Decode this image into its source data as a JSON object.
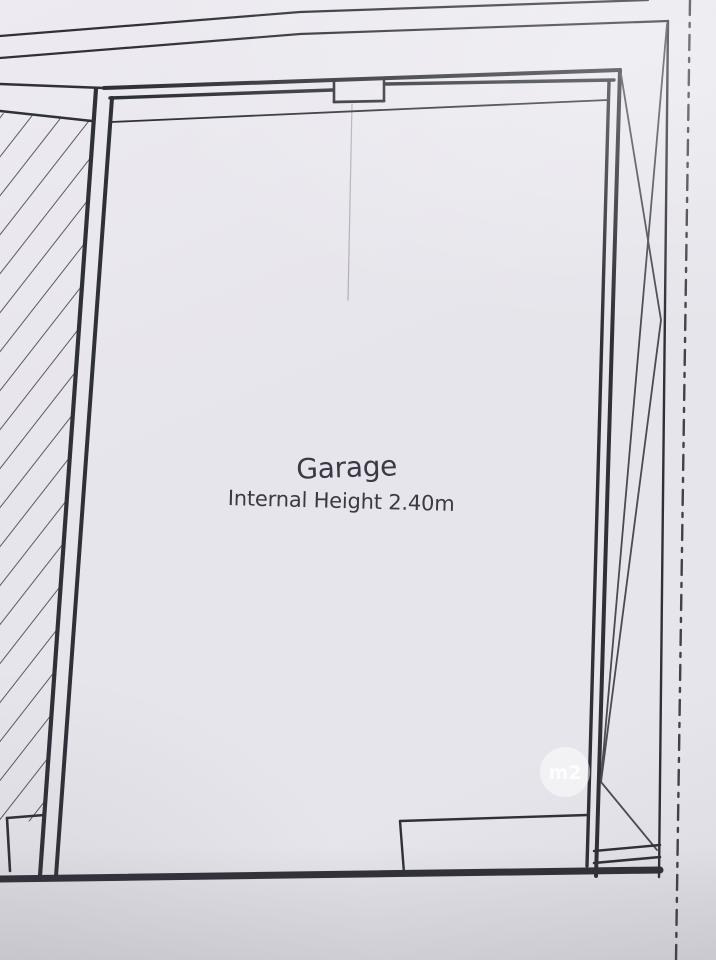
{
  "plan": {
    "room_label": "Garage",
    "room_note": "Internal Height 2.40m",
    "watermark_text": "m2",
    "colors": {
      "paper": "#e6e5eb",
      "paper_light": "#edebf1",
      "paper_dark": "#dbdae1",
      "ink": "#303039",
      "ink_light": "#4a4a55",
      "label": "#3a3a46",
      "watermark": "#ffffff"
    }
  }
}
